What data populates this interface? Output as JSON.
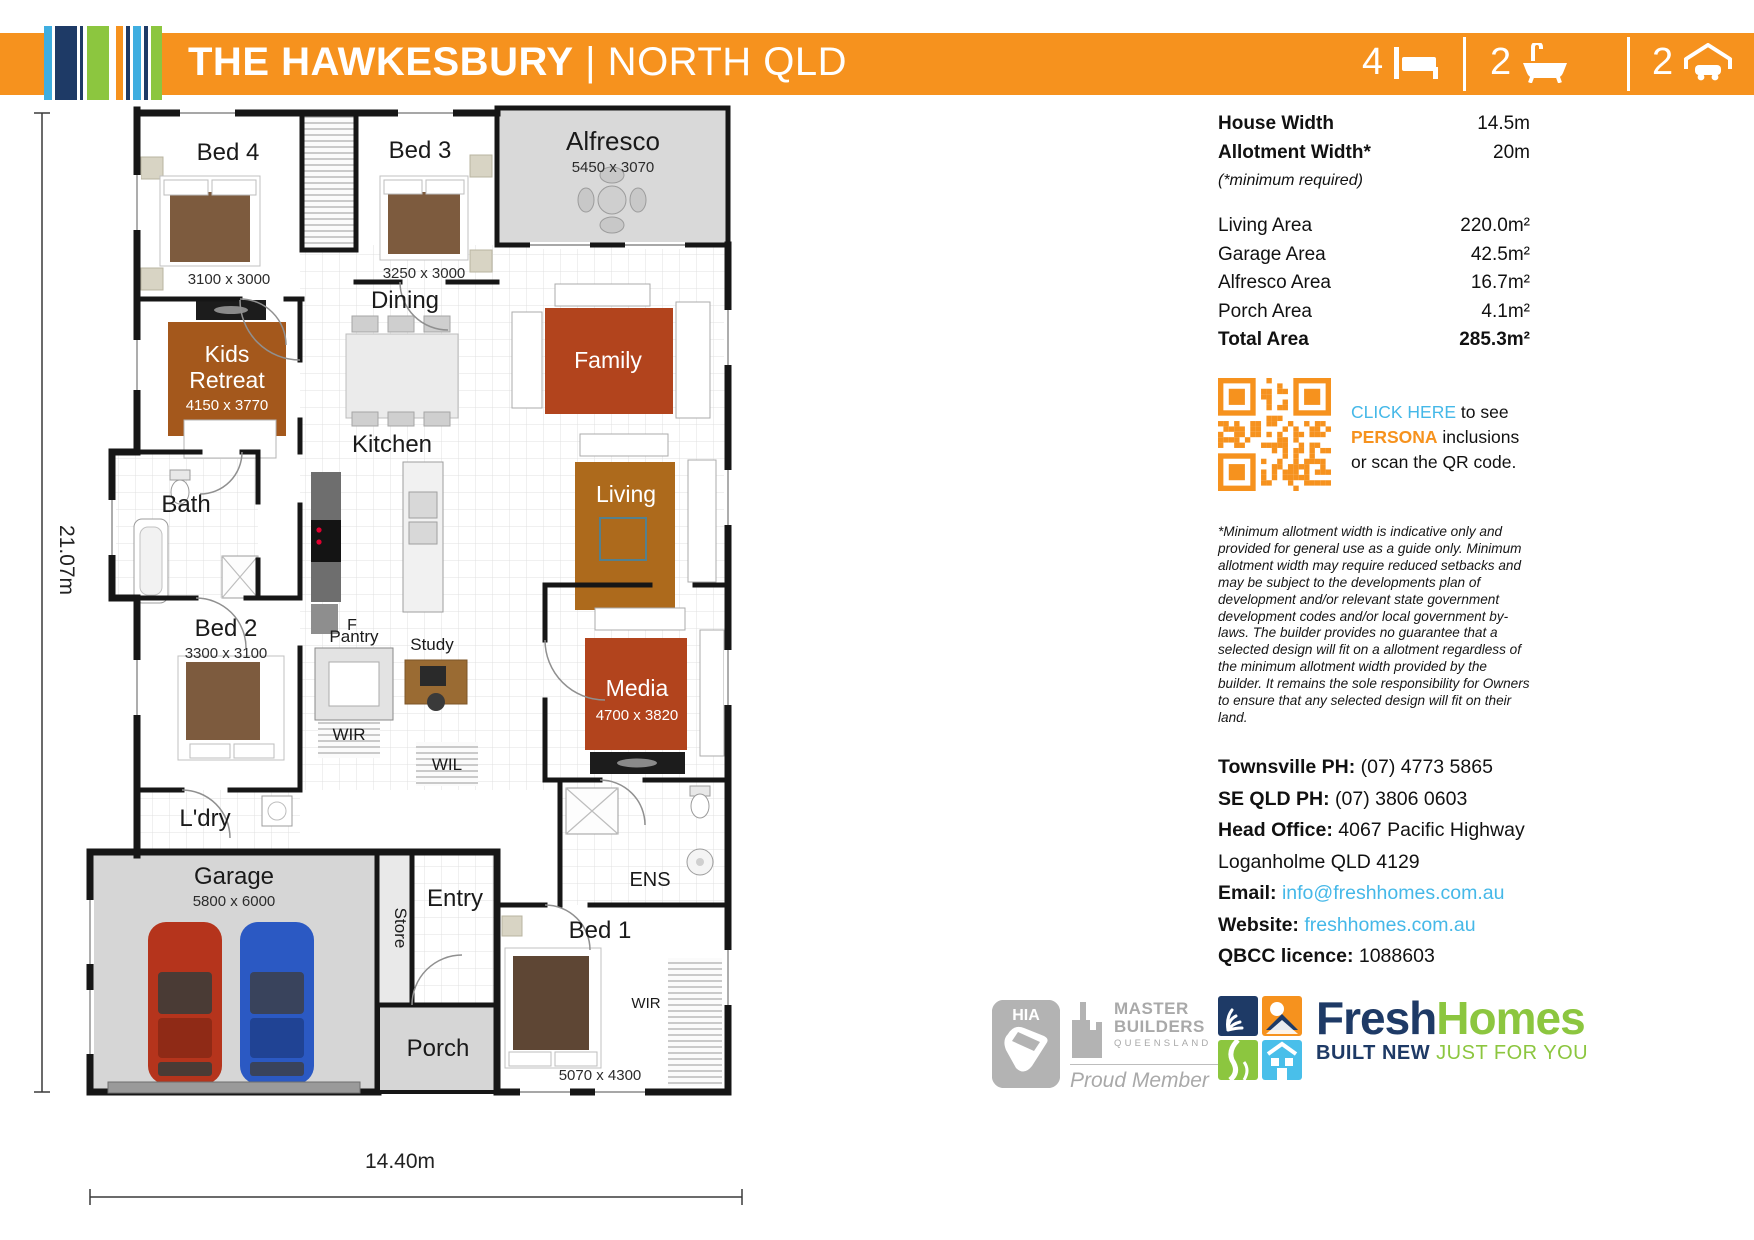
{
  "header": {
    "title": "THE HAWKESBURY",
    "subtitle": "| NORTH QLD",
    "stats": {
      "beds": "4",
      "baths": "2",
      "cars": "2"
    }
  },
  "colors": {
    "accent_orange": "#F6921E",
    "link_blue": "#45B8E8",
    "brand_navy": "#1E3A66",
    "brand_green": "#8CC63F"
  },
  "specs": {
    "top": [
      {
        "label": "House Width",
        "value": "14.5m"
      },
      {
        "label": "Allotment Width*",
        "value": "20m"
      }
    ],
    "note": "(*minimum required)",
    "rows": [
      {
        "label": "Living Area",
        "value": "220.0m²"
      },
      {
        "label": "Garage Area",
        "value": "42.5m²"
      },
      {
        "label": "Alfresco Area",
        "value": "16.7m²"
      },
      {
        "label": "Porch Area",
        "value": "4.1m²"
      },
      {
        "label": "Total Area",
        "value": "285.3m²"
      }
    ]
  },
  "qr": {
    "line1_link": "CLICK HERE",
    "line1_rest": " to see",
    "line2_brand": "PERSONA",
    "line2_rest": " inclusions",
    "line3": "or scan the QR code."
  },
  "disclaimer": "*Minimum allotment width is indicative only and provided for general use as a guide only. Minimum allotment width may require reduced setbacks and may be subject to the developments plan of development and/or relevant state government development codes and/or local government by-laws. The builder provides no guarantee that a selected design will fit on a allotment regardless of the minimum allotment width provided by the builder. It remains the sole responsibility for Owners to ensure that any selected design will fit on their land.",
  "contact": {
    "rows": [
      {
        "label": "Townsville PH:",
        "value": " (07) 4773 5865"
      },
      {
        "label": "SE QLD PH:",
        "value": " (07) 3806 0603"
      },
      {
        "label": "Head Office:",
        "value": " 4067 Pacific Highway"
      },
      {
        "label": "",
        "value": "Loganholme QLD 4129"
      },
      {
        "label": "Email:",
        "value": "info@freshhomes.com.au"
      },
      {
        "label": "Website:",
        "value": "freshhomes.com.au"
      },
      {
        "label": "QBCC licence:",
        "value": " 1088603"
      }
    ]
  },
  "logos": {
    "hia": "HIA",
    "mb_line1": "MASTER",
    "mb_line2": "BUILDERS",
    "mb_line3": "QUEENSLAND",
    "mb_line4": "Proud Member",
    "fresh_word1": "Fresh",
    "fresh_word2": "Homes",
    "tag_navy": "BUILT NEW",
    "tag_green": " JUST FOR YOU"
  },
  "plan": {
    "left_dim": "21.07m",
    "bottom_dim": "14.40m",
    "bed4": "Bed 4",
    "bed4_d": "3100 x 3000",
    "bed3": "Bed 3",
    "bed3_d": "3250 x 3000",
    "alfresco": "Alfresco",
    "alfresco_d": "5450 x 3070",
    "kids1": "Kids",
    "kids2": "Retreat",
    "kids_d": "4150 x 3770",
    "dining": "Dining",
    "family": "Family",
    "kitchen": "Kitchen",
    "living": "Living",
    "bath": "Bath",
    "bed2": "Bed 2",
    "bed2_d": "3300 x 3100",
    "pantry": "Pantry",
    "study": "Study",
    "wir_left": "WIR",
    "wil": "WIL",
    "media": "Media",
    "media_d": "4700 x 3820",
    "ldry": "L'dry",
    "garage": "Garage",
    "garage_d": "5800 x 6000",
    "store": "Store",
    "entry": "Entry",
    "ens": "ENS",
    "porch": "Porch",
    "bed1": "Bed 1",
    "bed1_d": "5070 x 4300",
    "wir_right": "WIR",
    "fridge": "F"
  }
}
